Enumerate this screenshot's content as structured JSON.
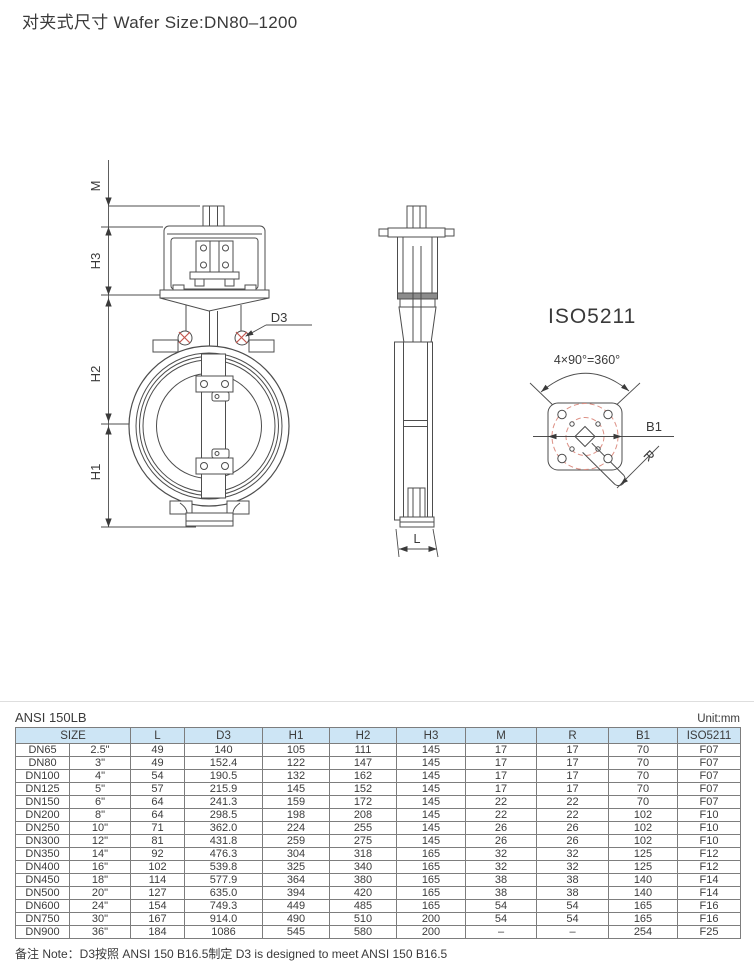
{
  "title": "对夹式尺寸 Wafer Size:DN80–1200",
  "colors": {
    "table_header_bg": "#cde5f5",
    "drawing_line": "#4d4d4d",
    "dashed_accent": "#dd9186",
    "mark_red": "#c4574e"
  },
  "drawing": {
    "front_view": {
      "dim_m": "M",
      "dim_h3": "H3",
      "dim_h2": "H2",
      "dim_h1": "H1",
      "callout_d3": "D3"
    },
    "side_view": {
      "dim_l": "L"
    },
    "iso_flange": {
      "title": "ISO5211",
      "angle_annotation": "4×90°=360°",
      "dim_b1": "B1",
      "dim_r": "R"
    }
  },
  "table": {
    "standard_label": "ANSI 150LB",
    "unit_label": "Unit:mm",
    "headers": [
      "SIZE",
      "L",
      "D3",
      "H1",
      "H2",
      "H3",
      "M",
      "R",
      "B1",
      "ISO5211"
    ],
    "rows": [
      [
        "DN65",
        "2.5\"",
        "49",
        "140",
        "105",
        "111",
        "145",
        "17",
        "17",
        "70",
        "F07"
      ],
      [
        "DN80",
        "3\"",
        "49",
        "152.4",
        "122",
        "147",
        "145",
        "17",
        "17",
        "70",
        "F07"
      ],
      [
        "DN100",
        "4\"",
        "54",
        "190.5",
        "132",
        "162",
        "145",
        "17",
        "17",
        "70",
        "F07"
      ],
      [
        "DN125",
        "5\"",
        "57",
        "215.9",
        "145",
        "152",
        "145",
        "17",
        "17",
        "70",
        "F07"
      ],
      [
        "DN150",
        "6\"",
        "64",
        "241.3",
        "159",
        "172",
        "145",
        "22",
        "22",
        "70",
        "F07"
      ],
      [
        "DN200",
        "8\"",
        "64",
        "298.5",
        "198",
        "208",
        "145",
        "22",
        "22",
        "102",
        "F10"
      ],
      [
        "DN250",
        "10\"",
        "71",
        "362.0",
        "224",
        "255",
        "145",
        "26",
        "26",
        "102",
        "F10"
      ],
      [
        "DN300",
        "12\"",
        "81",
        "431.8",
        "259",
        "275",
        "145",
        "26",
        "26",
        "102",
        "F10"
      ],
      [
        "DN350",
        "14\"",
        "92",
        "476.3",
        "304",
        "318",
        "165",
        "32",
        "32",
        "125",
        "F12"
      ],
      [
        "DN400",
        "16\"",
        "102",
        "539.8",
        "325",
        "340",
        "165",
        "32",
        "32",
        "125",
        "F12"
      ],
      [
        "DN450",
        "18\"",
        "114",
        "577.9",
        "364",
        "380",
        "165",
        "38",
        "38",
        "140",
        "F14"
      ],
      [
        "DN500",
        "20\"",
        "127",
        "635.0",
        "394",
        "420",
        "165",
        "38",
        "38",
        "140",
        "F14"
      ],
      [
        "DN600",
        "24\"",
        "154",
        "749.3",
        "449",
        "485",
        "165",
        "54",
        "54",
        "165",
        "F16"
      ],
      [
        "DN750",
        "30\"",
        "167",
        "914.0",
        "490",
        "510",
        "200",
        "54",
        "54",
        "165",
        "F16"
      ],
      [
        "DN900",
        "36\"",
        "184",
        "1086",
        "545",
        "580",
        "200",
        "–",
        "–",
        "254",
        "F25"
      ]
    ]
  },
  "note": "备注 Note：D3按照 ANSI 150 B16.5制定  D3 is designed to meet ANSI 150 B16.5"
}
